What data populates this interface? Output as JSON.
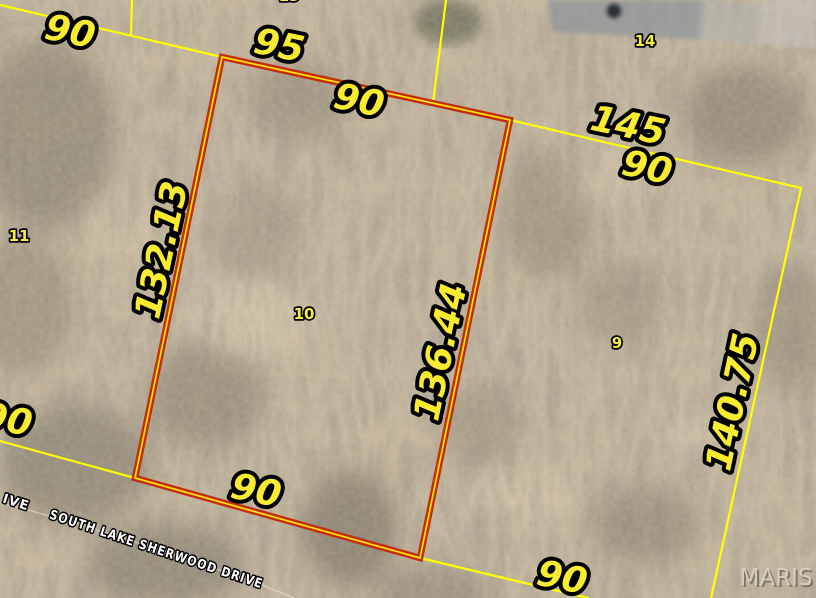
{
  "map": {
    "watermark": "MARIS",
    "highlighted_parcel": {
      "lot": "10",
      "boundary_dimensions": {
        "top": "90",
        "right": "136.44",
        "bottom": "90",
        "left": "132.13"
      }
    },
    "labels": {
      "dim_90_topleft": "90",
      "dim_95": "95",
      "dim_90_top": "90",
      "dim_145": "145",
      "dim_90_topright": "90",
      "dim_132_13": "132.13",
      "dim_136_44": "136.44",
      "dim_140_75": "140.75",
      "dim_90_left": "90",
      "dim_90_bottom": "90",
      "dim_90_bottomright": "90"
    },
    "lots": {
      "lot_9": "9",
      "lot_10": "10",
      "lot_11": "11",
      "lot_13": "13",
      "lot_14": "14"
    },
    "streets": {
      "south_lake_sherwood": "SOUTH LAKE SHERWOOD DRIVE",
      "partial_left": "IVE"
    },
    "colors": {
      "boundary_yellow": "#ffff00",
      "highlight_red": "#c32d04",
      "highlight_core_yellow": "#ffe600",
      "label_yellow": "#f9ec30",
      "street_label_white": "#ffffff",
      "terrain_tan": "#c6b69b"
    }
  }
}
